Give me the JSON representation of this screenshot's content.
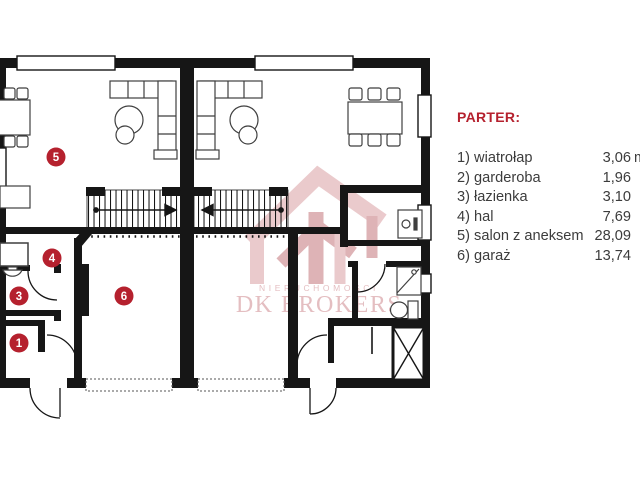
{
  "colors": {
    "wall": "#161616",
    "furniture": "#3f3f3f",
    "marker_red": "#b5212e",
    "watermark_pink_light": "#e2b2b5",
    "watermark_pink_dark": "#cf9094",
    "legend_title_red": "#b5212e",
    "legend_text": "#3c3c3c"
  },
  "watermark": {
    "name_small": "NIERUCHOMOŚCI",
    "name_large": "DK BROKERS"
  },
  "plan": {
    "markers": [
      {
        "label": "5"
      },
      {
        "label": "4"
      },
      {
        "label": "3"
      },
      {
        "label": "1"
      },
      {
        "label": "6"
      }
    ]
  },
  "legend": {
    "title": "PARTER:",
    "items": [
      {
        "no": "1)",
        "label": "wiatrołap",
        "value": "3,06",
        "unit": " m²"
      },
      {
        "no": "2)",
        "label": "garderoba",
        "value": "1,96",
        "unit": ""
      },
      {
        "no": "3)",
        "label": "łazienka",
        "value": "3,10",
        "unit": ""
      },
      {
        "no": "4)",
        "label": "hal",
        "value": "7,69",
        "unit": ""
      },
      {
        "no": "5)",
        "label": "salon z aneksem",
        "value": "28,09",
        "unit": ""
      },
      {
        "no": "6)",
        "label": "garaż",
        "value": "13,74",
        "unit": ""
      }
    ]
  }
}
